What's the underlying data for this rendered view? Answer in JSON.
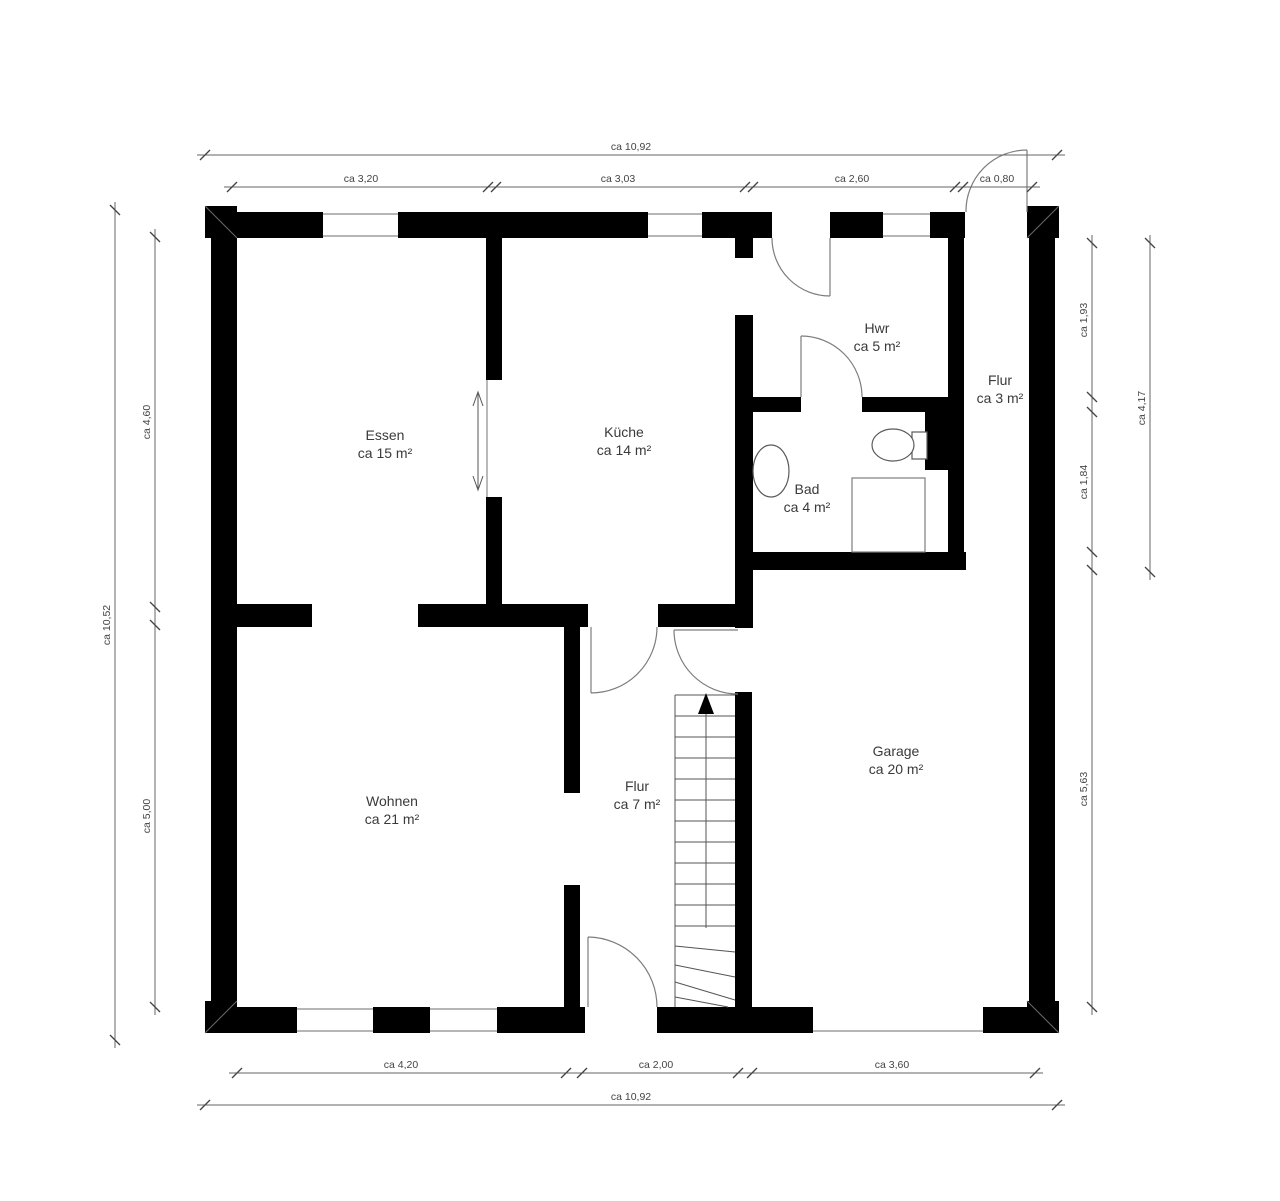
{
  "plan": {
    "type": "floor-plan",
    "language": "de",
    "rooms": [
      {
        "id": "essen",
        "name": "Essen",
        "area": "ca 15 m²"
      },
      {
        "id": "kueche",
        "name": "Küche",
        "area": "ca 14 m²"
      },
      {
        "id": "hwr",
        "name": "Hwr",
        "area": "ca 5 m²"
      },
      {
        "id": "flur-klein",
        "name": "Flur",
        "area": "ca 3 m²"
      },
      {
        "id": "bad",
        "name": "Bad",
        "area": "ca 4 m²"
      },
      {
        "id": "wohnen",
        "name": "Wohnen",
        "area": "ca 21 m²"
      },
      {
        "id": "flur-gross",
        "name": "Flur",
        "area": "ca 7 m²"
      },
      {
        "id": "garage",
        "name": "Garage",
        "area": "ca 20 m²"
      }
    ],
    "dims": {
      "top_total": "ca 10,92",
      "bottom_total": "ca 10,92",
      "left_total": "ca 10,52",
      "right_outer": "ca 4,17",
      "top": [
        "ca 3,20",
        "ca 3,03",
        "ca 2,60",
        "ca 0,80"
      ],
      "left": [
        "ca 4,60",
        "ca 5,00"
      ],
      "right": [
        "ca 1,93",
        "ca 1,84",
        "ca 5,63"
      ],
      "bottom": [
        "ca 4,20",
        "ca 2,00",
        "ca 3,60"
      ]
    },
    "colors": {
      "wall": "#000000",
      "thin_line": "#8a8a8a",
      "dimension_line": "#666666",
      "text": "#3a3a3a",
      "background": "#ffffff"
    }
  }
}
